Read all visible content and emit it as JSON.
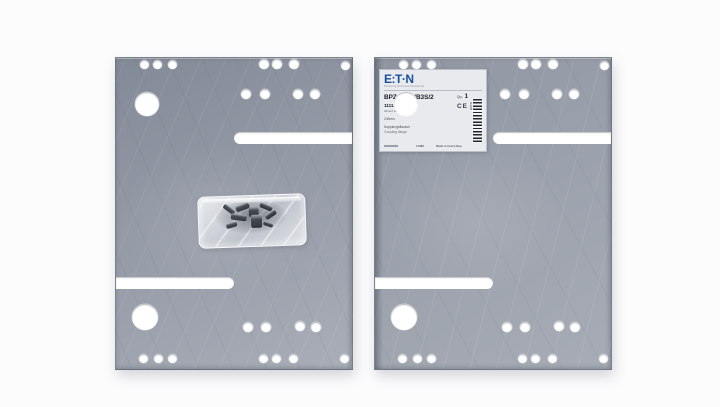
{
  "scene": {
    "description": "Product photograph of two galvanized sheet-steel mounting plates (coupling flange set); left plate has a clear plastic bag of screws lying on it, right plate carries an Eaton product label in its upper-left corner"
  },
  "colors": {
    "background": "#fcfcfd",
    "plate_base": "#949aa6",
    "plate_dark": "#838a97",
    "plate_light": "#a9aeb8",
    "hole": "#ffffff",
    "label_bg": "#e9eaee",
    "eaton_blue": "#1a4f9c"
  },
  "plates": {
    "size": {
      "w": 236,
      "h": 311
    },
    "positions": [
      {
        "name": "plate-left",
        "left": 115,
        "top": 57
      },
      {
        "name": "plate-right",
        "left": 374,
        "top": 57
      }
    ],
    "holes": [
      {
        "x": 28,
        "y": 6,
        "r": 4.5
      },
      {
        "x": 41,
        "y": 6,
        "r": 4.5
      },
      {
        "x": 56,
        "y": 6,
        "r": 4.5
      },
      {
        "x": 148,
        "y": 6,
        "r": 5
      },
      {
        "x": 161,
        "y": 6,
        "r": 5
      },
      {
        "x": 178,
        "y": 6,
        "r": 5
      },
      {
        "x": 229,
        "y": 7,
        "r": 4.5
      },
      {
        "x": 130,
        "y": 36,
        "r": 5
      },
      {
        "x": 149,
        "y": 36,
        "r": 5
      },
      {
        "x": 182,
        "y": 36,
        "r": 5
      },
      {
        "x": 199,
        "y": 36,
        "r": 5
      },
      {
        "x": 31,
        "y": 46,
        "r": 12
      },
      {
        "x": 29,
        "y": 259,
        "r": 13
      },
      {
        "x": 132,
        "y": 269,
        "r": 5
      },
      {
        "x": 150,
        "y": 269,
        "r": 5
      },
      {
        "x": 184,
        "y": 268,
        "r": 5
      },
      {
        "x": 200,
        "y": 269,
        "r": 5
      },
      {
        "x": 27,
        "y": 300,
        "r": 4.5
      },
      {
        "x": 42,
        "y": 300,
        "r": 4.5
      },
      {
        "x": 56,
        "y": 300,
        "r": 4.5
      },
      {
        "x": 147,
        "y": 300,
        "r": 4.5
      },
      {
        "x": 160,
        "y": 300,
        "r": 4.5
      },
      {
        "x": 177,
        "y": 300,
        "r": 4.5
      },
      {
        "x": 228,
        "y": 300,
        "r": 4.5
      }
    ],
    "slots": [
      {
        "x": 118,
        "y": 74,
        "w": 118,
        "h": 12,
        "open": "right"
      },
      {
        "x": 0,
        "y": 219,
        "w": 118,
        "h": 12,
        "open": "left"
      }
    ]
  },
  "bag": {
    "left": 197,
    "top": 194,
    "width": 106,
    "height": 50,
    "screws": [
      {
        "x": 24,
        "y": 10,
        "w": 13,
        "h": 5,
        "rot": 38
      },
      {
        "x": 37,
        "y": 8,
        "w": 14,
        "h": 6,
        "rot": -18
      },
      {
        "x": 50,
        "y": 11,
        "w": 10,
        "h": 10,
        "rot": 0
      },
      {
        "x": 61,
        "y": 9,
        "w": 13,
        "h": 5,
        "rot": 24
      },
      {
        "x": 32,
        "y": 18,
        "w": 16,
        "h": 6,
        "rot": 10
      },
      {
        "x": 52,
        "y": 19,
        "w": 11,
        "h": 13,
        "rot": 0
      },
      {
        "x": 66,
        "y": 17,
        "w": 12,
        "h": 5,
        "rot": -32
      },
      {
        "x": 27,
        "y": 26,
        "w": 11,
        "h": 5,
        "rot": -14
      },
      {
        "x": 64,
        "y": 27,
        "w": 10,
        "h": 4,
        "rot": 20
      }
    ]
  },
  "label": {
    "left": 378,
    "top": 68,
    "width": 106,
    "height": 81,
    "brand": "E:T·N",
    "tagline": "Powering Business Worldwide",
    "catalog_no": "BPZ-BR/WB3S/2",
    "qty_label": "Qty.",
    "qty_value": "1",
    "article_no": "111128",
    "ce_mark": "CE",
    "series": "xBoard Serie",
    "dimension": "240mm",
    "desc_de": "Kupplungsflansch",
    "desc_en": "Coupling flange",
    "footer_code": "1438K",
    "origin": "Made in Czech Rep.",
    "barcode_digits": "111128"
  }
}
